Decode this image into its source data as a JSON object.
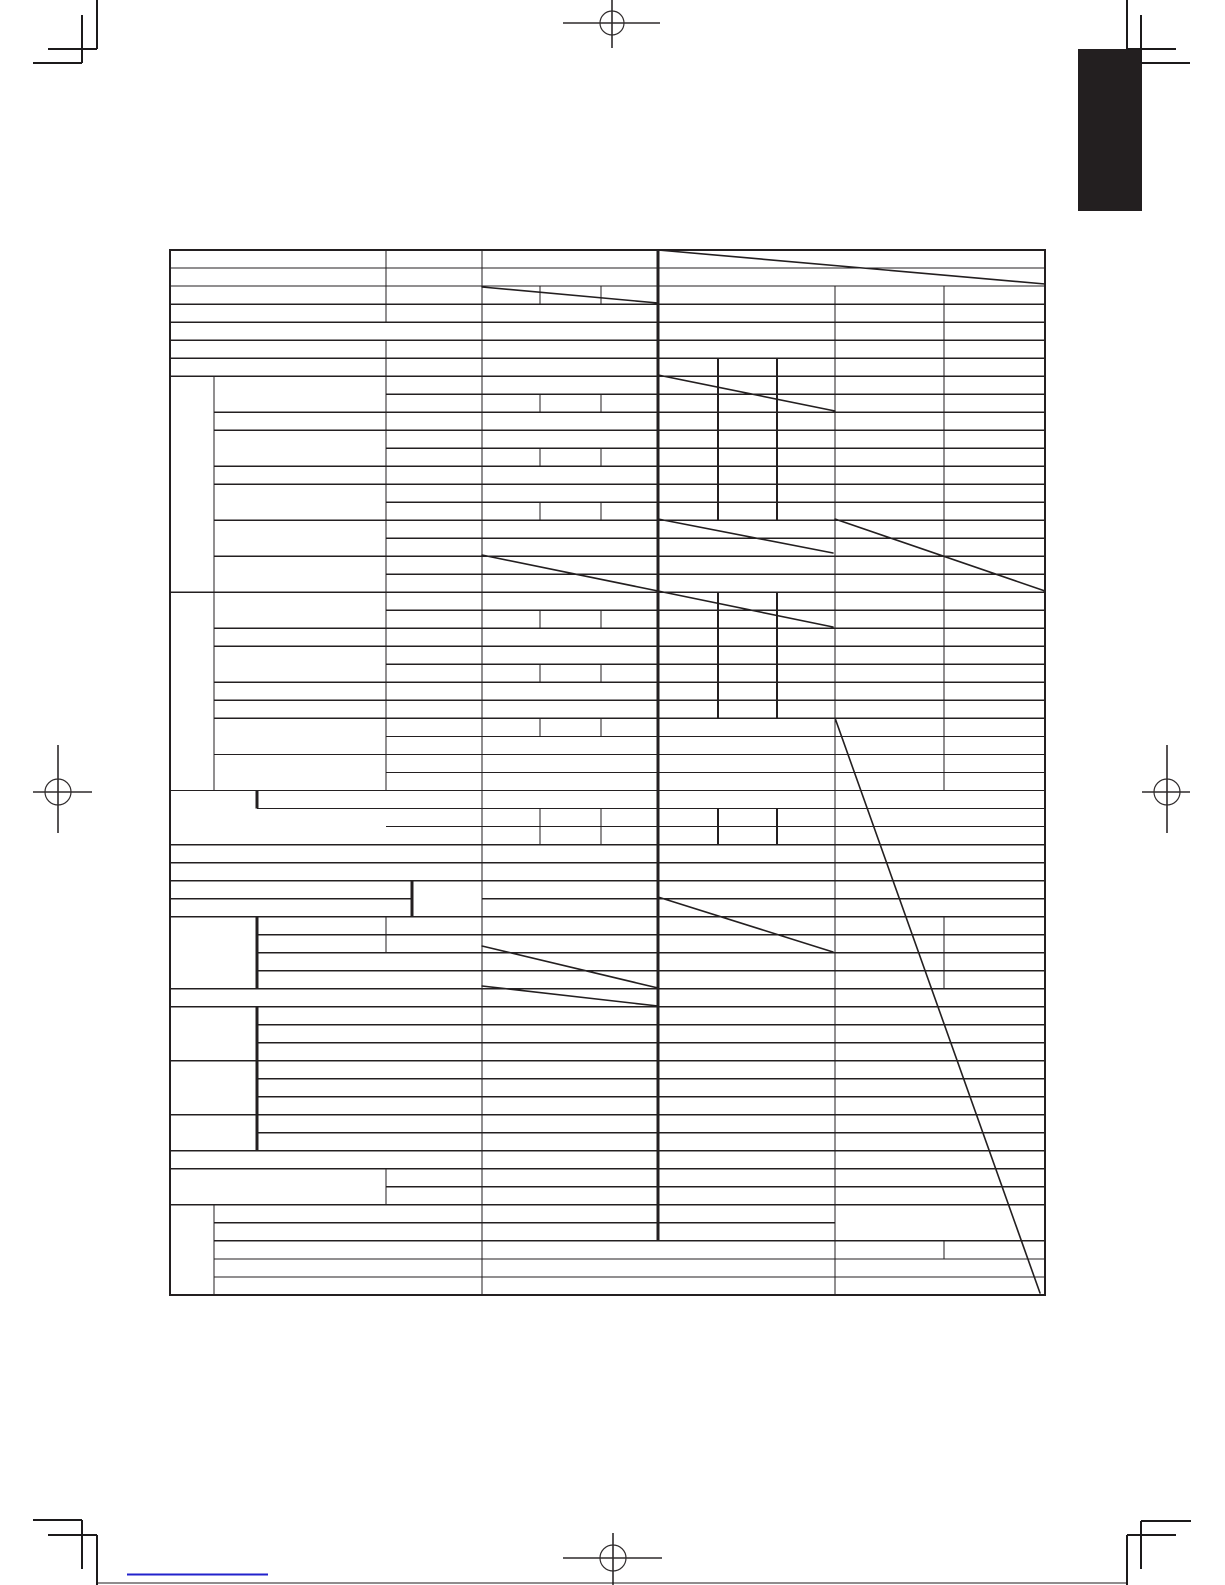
{
  "page": {
    "width": 1225,
    "height": 1585,
    "background": "#ffffff",
    "ink": "#231f20",
    "description": "blank-specifications-table-page"
  },
  "chapter_tab": {
    "x": 1078,
    "y": 49,
    "width": 64,
    "height": 162,
    "color": "#231f20"
  },
  "table": {
    "x": 170,
    "y": 250,
    "width": 875,
    "height": 1045,
    "border_width": 2,
    "line_width_normal": 1.4,
    "line_width_medium": 2.2,
    "line_width_bold": 3,
    "row_y0": 250,
    "row_pitch": 18.017,
    "row_count": 58,
    "columns": {
      "L": 170,
      "A": 214,
      "B": 257,
      "C": 386,
      "A2": 412,
      "D": 482,
      "D1": 540,
      "D2": 601,
      "E": 658,
      "E1": 718,
      "E2": 777,
      "F": 835,
      "G": 944,
      "R": 1045
    },
    "h_lines": [
      [
        0,
        "L",
        "R"
      ],
      [
        1,
        "L",
        "R"
      ],
      [
        2,
        "L",
        "R"
      ],
      [
        3,
        "L",
        "R"
      ],
      [
        4,
        "L",
        "R"
      ],
      [
        5,
        "L",
        "R"
      ],
      [
        6,
        "L",
        "R"
      ],
      [
        7,
        "L",
        "R"
      ],
      [
        8,
        "C",
        "R"
      ],
      [
        9,
        "A",
        "R"
      ],
      [
        10,
        "A",
        "R"
      ],
      [
        11,
        "C",
        "R"
      ],
      [
        12,
        "A",
        "R"
      ],
      [
        13,
        "A",
        "R"
      ],
      [
        14,
        "C",
        "R"
      ],
      [
        15,
        "A",
        "R"
      ],
      [
        16,
        "C",
        "R"
      ],
      [
        17,
        "A",
        "R"
      ],
      [
        18,
        "C",
        "R"
      ],
      [
        19,
        "L",
        "R"
      ],
      [
        20,
        "C",
        "R"
      ],
      [
        21,
        "A",
        "R"
      ],
      [
        22,
        "A",
        "R"
      ],
      [
        23,
        "C",
        "R"
      ],
      [
        24,
        "A",
        "R"
      ],
      [
        25,
        "A",
        "R"
      ],
      [
        26,
        "A",
        "R"
      ],
      [
        27,
        "C",
        "R"
      ],
      [
        28,
        "A",
        "R"
      ],
      [
        29,
        "C",
        "R"
      ],
      [
        30,
        "L",
        "R"
      ],
      [
        31,
        "B",
        "R"
      ],
      [
        32,
        "C",
        "R"
      ],
      [
        33,
        "L",
        "R"
      ],
      [
        34,
        "L",
        "R"
      ],
      [
        35,
        "L",
        "R"
      ],
      [
        36,
        "L",
        "A2"
      ],
      [
        36,
        "D",
        "R"
      ],
      [
        37,
        "L",
        "R"
      ],
      [
        38,
        "B",
        "R"
      ],
      [
        39,
        "B",
        "R"
      ],
      [
        40,
        "B",
        "R"
      ],
      [
        41,
        "L",
        "R"
      ],
      [
        42,
        "L",
        "R"
      ],
      [
        43,
        "B",
        "R"
      ],
      [
        44,
        "B",
        "R"
      ],
      [
        45,
        "L",
        "R"
      ],
      [
        46,
        "B",
        "R"
      ],
      [
        47,
        "B",
        "R"
      ],
      [
        48,
        "L",
        "R"
      ],
      [
        49,
        "B",
        "R"
      ],
      [
        50,
        "L",
        "R"
      ],
      [
        51,
        "L",
        "R"
      ],
      [
        52,
        "C",
        "R"
      ],
      [
        53,
        "L",
        "R"
      ],
      [
        54,
        "A",
        "F"
      ],
      [
        55,
        "A",
        "R"
      ],
      [
        56,
        "A",
        "R"
      ],
      [
        57,
        "A",
        "R"
      ],
      [
        58,
        "L",
        "R"
      ]
    ],
    "v_lines": [
      [
        "A",
        7,
        30,
        "n"
      ],
      [
        "A",
        53,
        58,
        "n"
      ],
      [
        "A2",
        35,
        37,
        "b"
      ],
      [
        "B",
        30,
        31,
        "b"
      ],
      [
        "B",
        37,
        41,
        "b"
      ],
      [
        "B",
        42,
        50,
        "b"
      ],
      [
        "C",
        0,
        4,
        "n"
      ],
      [
        "C",
        5,
        30,
        "n"
      ],
      [
        "C",
        37,
        39,
        "n"
      ],
      [
        "C",
        51,
        53,
        "n"
      ],
      [
        "D",
        0,
        58,
        "n"
      ],
      [
        "D1",
        2,
        3,
        "n"
      ],
      [
        "D1",
        8,
        9,
        "n"
      ],
      [
        "D1",
        11,
        12,
        "n"
      ],
      [
        "D1",
        14,
        15,
        "n"
      ],
      [
        "D1",
        20,
        21,
        "n"
      ],
      [
        "D1",
        23,
        24,
        "n"
      ],
      [
        "D1",
        26,
        27,
        "n"
      ],
      [
        "D1",
        31,
        33,
        "n"
      ],
      [
        "D2",
        2,
        3,
        "n"
      ],
      [
        "D2",
        8,
        9,
        "n"
      ],
      [
        "D2",
        11,
        12,
        "n"
      ],
      [
        "D2",
        14,
        15,
        "n"
      ],
      [
        "D2",
        20,
        21,
        "n"
      ],
      [
        "D2",
        23,
        24,
        "n"
      ],
      [
        "D2",
        26,
        27,
        "n"
      ],
      [
        "D2",
        31,
        33,
        "n"
      ],
      [
        "E",
        0,
        55,
        "b"
      ],
      [
        "E1",
        6,
        15,
        "m"
      ],
      [
        "E1",
        19,
        26,
        "m"
      ],
      [
        "E1",
        31,
        33,
        "m"
      ],
      [
        "E2",
        6,
        15,
        "m"
      ],
      [
        "E2",
        19,
        26,
        "m"
      ],
      [
        "E2",
        31,
        33,
        "m"
      ],
      [
        "F",
        2,
        58,
        "n"
      ],
      [
        "G",
        2,
        30,
        "n"
      ],
      [
        "G",
        37,
        41,
        "n"
      ],
      [
        "G",
        55,
        56,
        "n"
      ]
    ],
    "diagonals": [
      [
        658,
        250,
        1045,
        284
      ],
      [
        482,
        287,
        658,
        303
      ],
      [
        658,
        375,
        835,
        411
      ],
      [
        658,
        519,
        833,
        553
      ],
      [
        835,
        519,
        1045,
        591
      ],
      [
        482,
        555,
        658,
        591
      ],
      [
        658,
        591,
        833,
        627
      ],
      [
        658,
        897,
        833,
        952
      ],
      [
        482,
        946,
        658,
        988
      ],
      [
        482,
        986,
        658,
        1006
      ],
      [
        835,
        718,
        1040,
        1293
      ]
    ]
  },
  "print_marks": {
    "line_width": 1.6,
    "corner_lines": [
      [
        97,
        0,
        97,
        49
      ],
      [
        48,
        49,
        97,
        49
      ],
      [
        82,
        15,
        82,
        63
      ],
      [
        33,
        63,
        82,
        63
      ],
      [
        1127,
        0,
        1127,
        49
      ],
      [
        1127,
        49,
        1176,
        49
      ],
      [
        1141,
        15,
        1141,
        63
      ],
      [
        1141,
        63,
        1190,
        63
      ],
      [
        97,
        1535,
        97,
        1585
      ],
      [
        48,
        1535,
        97,
        1535
      ],
      [
        82,
        1520,
        82,
        1569
      ],
      [
        33,
        1520,
        82,
        1520
      ],
      [
        1127,
        1535,
        1127,
        1585
      ],
      [
        1127,
        1535,
        1176,
        1535
      ],
      [
        1141,
        1521,
        1141,
        1569
      ],
      [
        1141,
        1521,
        1191,
        1521
      ]
    ],
    "crosshairs": [
      {
        "cx": 612,
        "cy": 23,
        "r": 12,
        "h": [
          563,
          660
        ],
        "v": [
          0,
          48
        ]
      },
      {
        "cx": 58,
        "cy": 792,
        "r": 13,
        "h": [
          33,
          92
        ],
        "v": [
          745,
          833
        ]
      },
      {
        "cx": 1167,
        "cy": 792,
        "r": 13,
        "h": [
          1142,
          1190
        ],
        "v": [
          745,
          833
        ]
      },
      {
        "cx": 613,
        "cy": 1558,
        "r": 13,
        "h": [
          563,
          662
        ],
        "v": [
          1533,
          1585
        ]
      }
    ]
  },
  "footer": {
    "rule": [
      97,
      1583,
      1127,
      1583
    ],
    "link_underline": {
      "x1": 127,
      "y1": 1574.5,
      "x2": 268,
      "y2": 1574.5,
      "color": "#2222cc",
      "width": 2.2
    }
  }
}
